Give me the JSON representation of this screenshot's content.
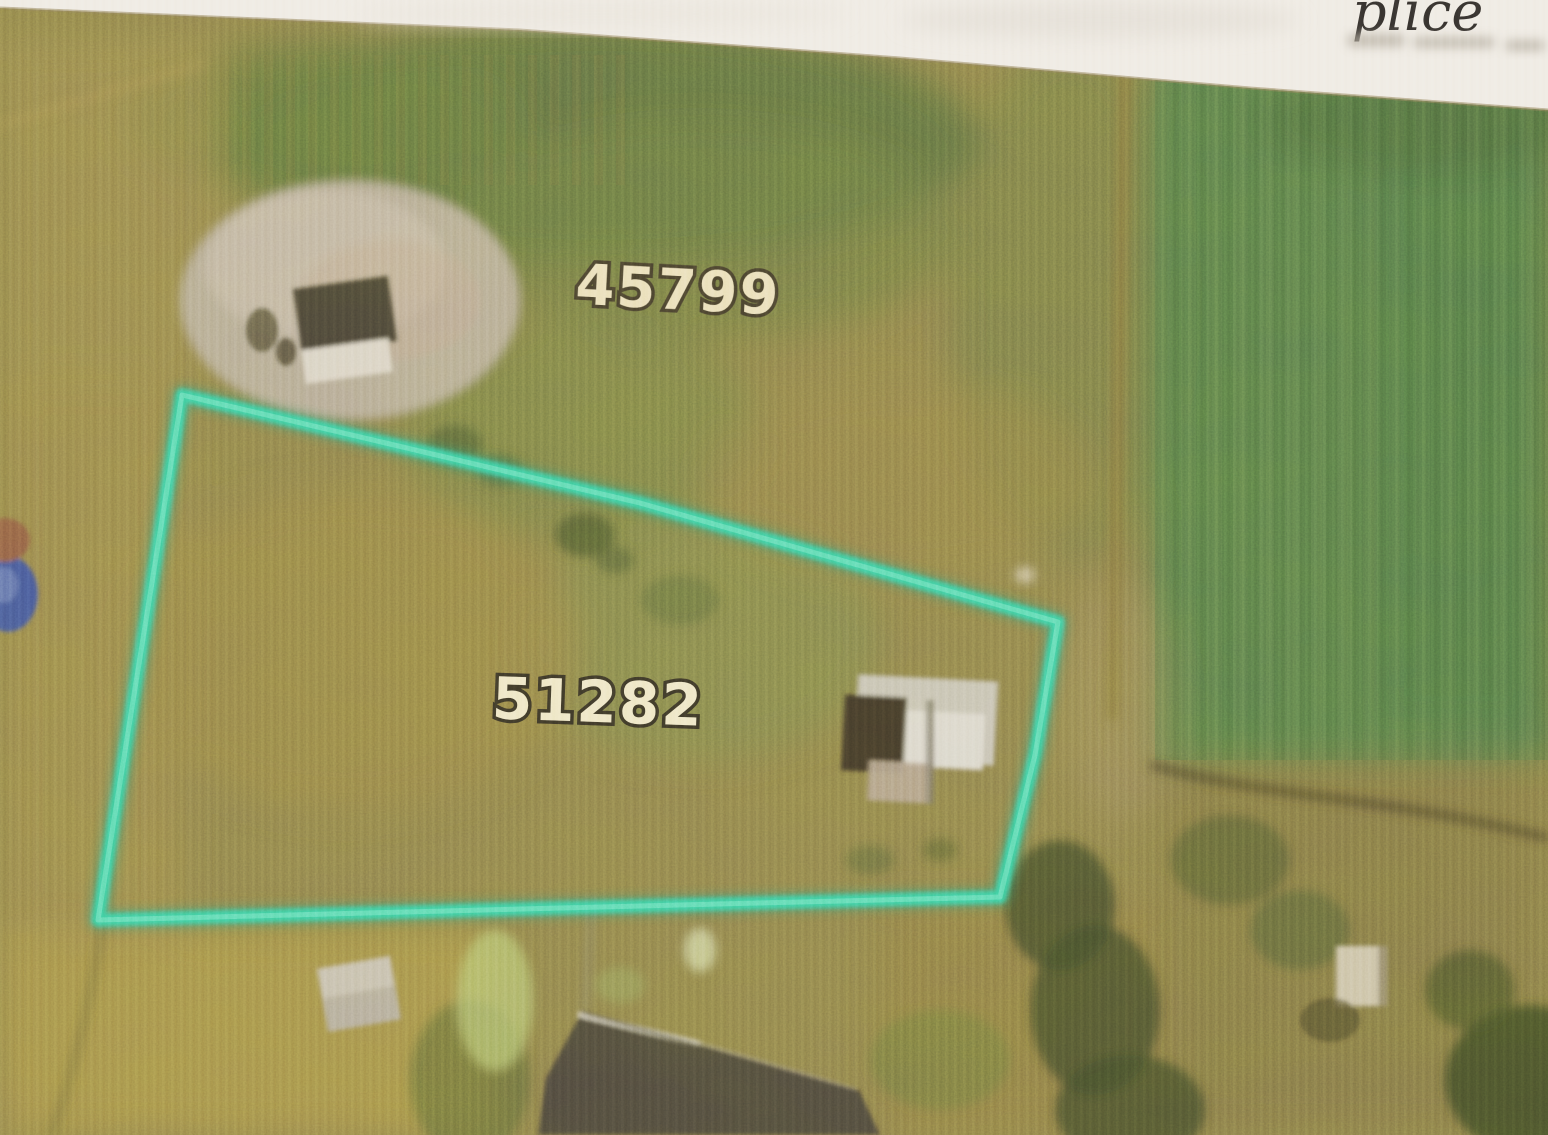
{
  "document": {
    "kind": "scanned aerial parcel map",
    "paper_note_fragment": "plice"
  },
  "map": {
    "adjacent_parcel": {
      "label": "45799",
      "label_color": "#eadfbb"
    },
    "selected_parcel": {
      "label": "51282",
      "label_color": "#eee6c6"
    },
    "boundary": {
      "color": "#3ed1a7"
    }
  }
}
